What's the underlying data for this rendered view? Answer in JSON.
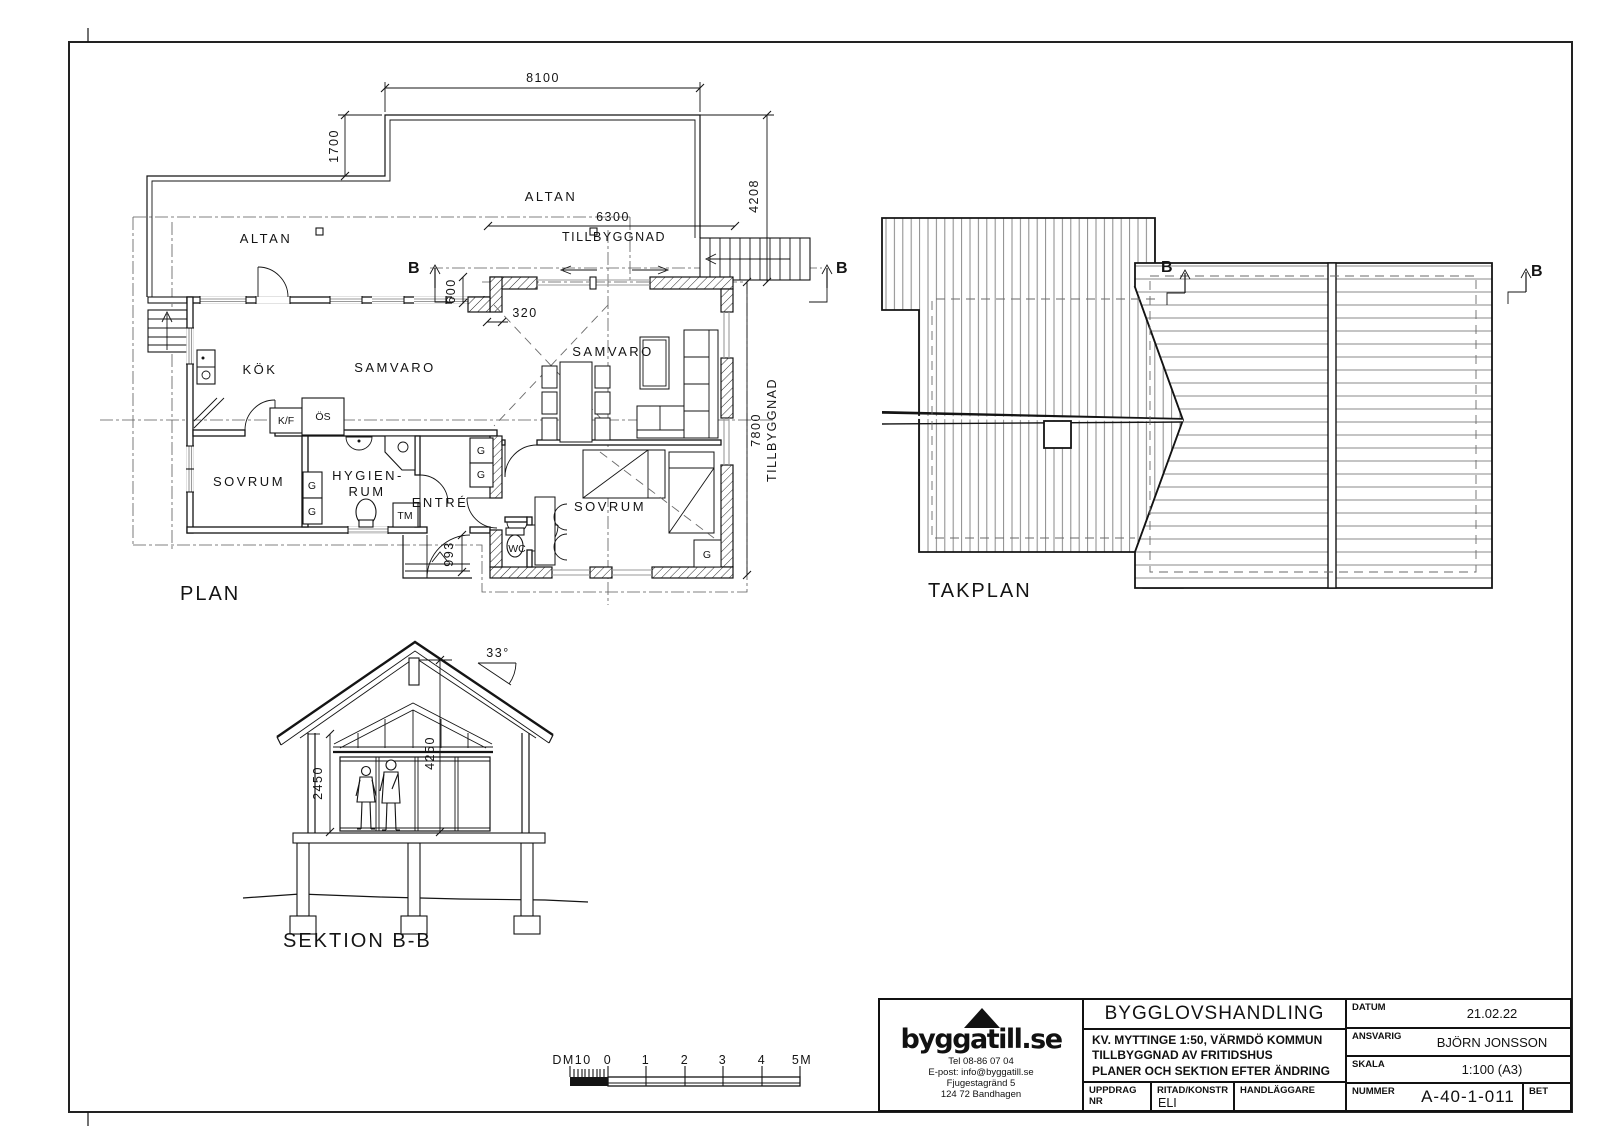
{
  "plan": {
    "label": "PLAN",
    "altan": "ALTAN",
    "rooms": {
      "kok": "KÖK",
      "samvaro": "SAMVARO",
      "sovrum": "SOVRUM",
      "hygien1": "HYGIEN-",
      "hygien2": "RUM",
      "entre": "ENTRÉ",
      "wc": "WC"
    },
    "fixtures": {
      "kf": "K/F",
      "os": "ÖS",
      "g": "G",
      "tm": "TM"
    },
    "dims": {
      "d8100": "8100",
      "d1700": "1700",
      "d4208": "4208",
      "d6300": "6300",
      "d600": "600",
      "d320": "320",
      "d993": "993",
      "d7800": "7800",
      "tillbyggnad": "TILLBYGGNAD"
    },
    "marker": "B"
  },
  "takplan": {
    "label": "TAKPLAN",
    "marker": "B"
  },
  "section": {
    "label": "SEKTION B-B",
    "angle": "33°",
    "d2450": "2450",
    "d4250": "4250"
  },
  "scalebar": {
    "labels": [
      "DM10",
      "0",
      "1",
      "2",
      "3",
      "4",
      "5M"
    ]
  },
  "titleblock": {
    "logo": "byggatill.se",
    "contact": [
      "Tel 08-86 07 04",
      "E-post: info@byggatill.se",
      "Fjugestagränd 5",
      "124 72 Bandhagen"
    ],
    "doc_type": "BYGGLOVSHANDLING",
    "project_lines": [
      "KV. MYTTINGE 1:50, VÄRMDÖ KOMMUN",
      "TILLBYGGNAD AV FRITIDSHUS",
      "PLANER OCH SEKTION EFTER ÄNDRING"
    ],
    "labels": {
      "datum": "DATUM",
      "ansvarig": "ANSVARIG",
      "skala": "SKALA",
      "nummer": "NUMMER",
      "bet": "BET",
      "uppdrag": "UPPDRAG NR",
      "ritad": "RITAD/KONSTR",
      "handlaggare": "HANDLÄGGARE"
    },
    "values": {
      "datum": "21.02.22",
      "ansvarig": "BJÖRN JONSSON",
      "skala": "1:100 (A3)",
      "nummer": "A-40-1-011",
      "ritad": "ELI"
    }
  }
}
